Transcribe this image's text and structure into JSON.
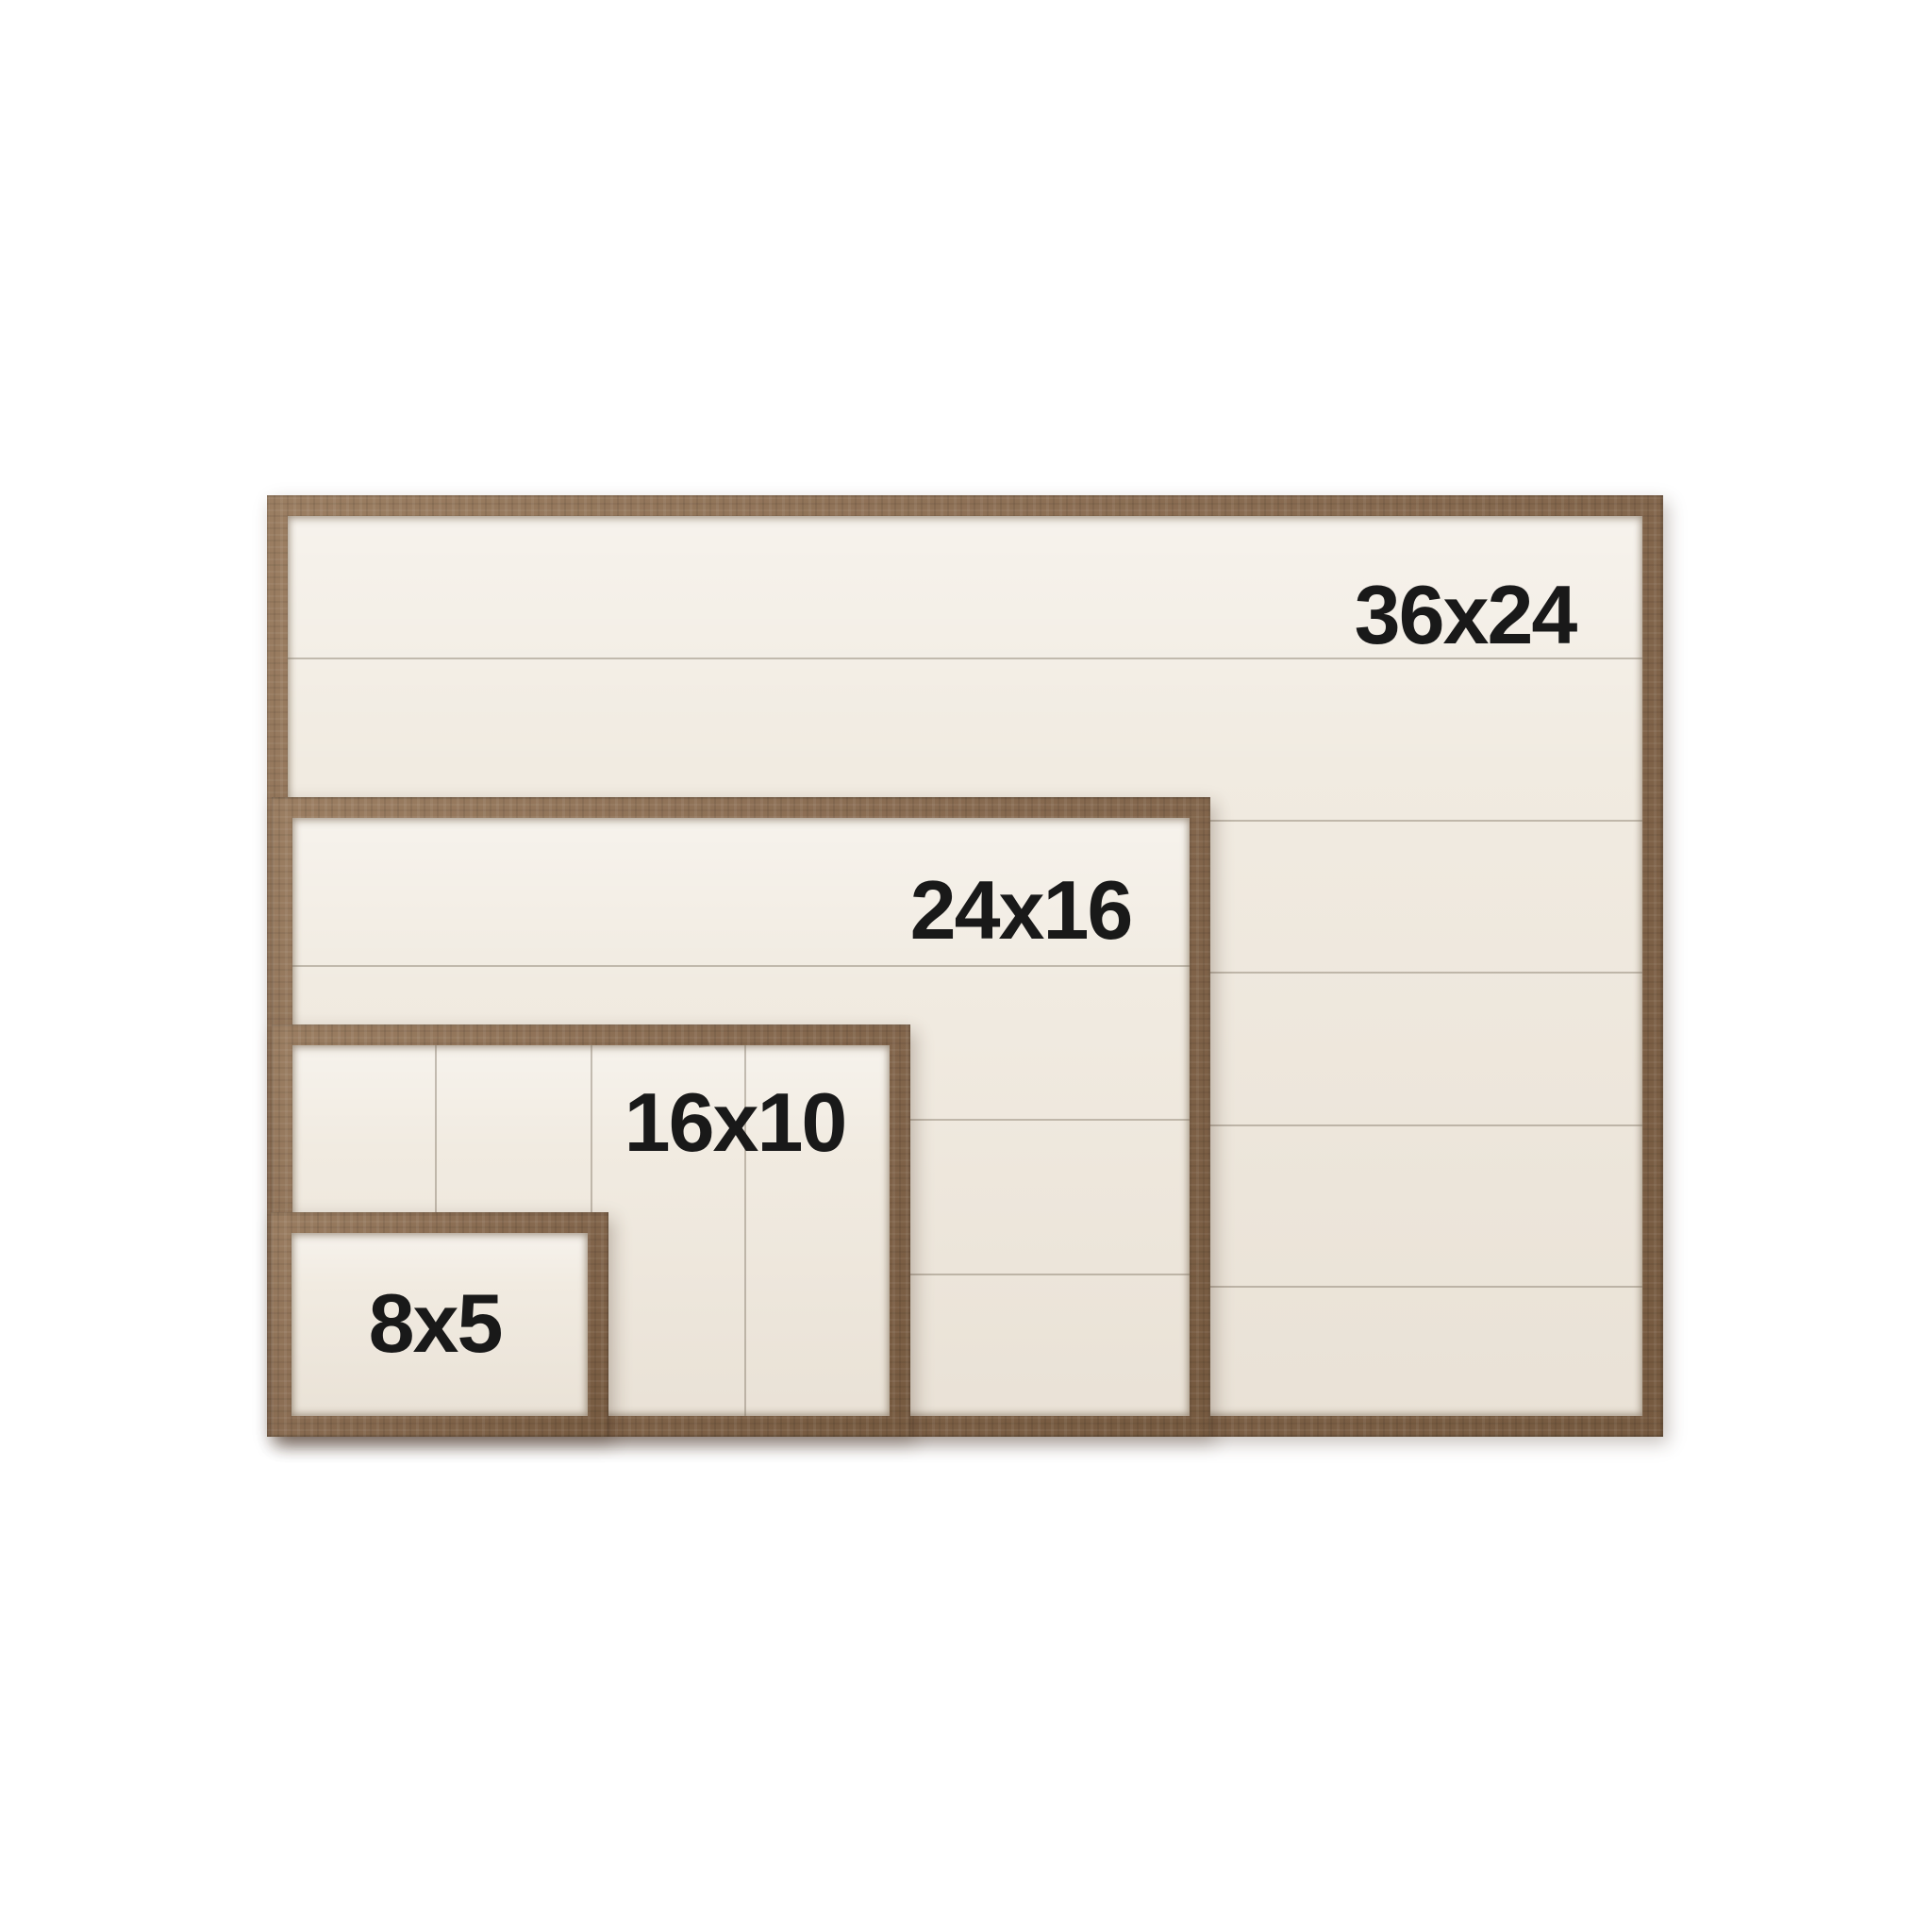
{
  "photo": {
    "background_color": "#ffffff",
    "wood_color": "#8a6c52",
    "panel_color": "#f1ebe1",
    "groove_color": "#7c7060",
    "label_color": "#191919",
    "frames": [
      {
        "label": "36x24",
        "width_in": 36,
        "height_in": 24
      },
      {
        "label": "24x16",
        "width_in": 24,
        "height_in": 16
      },
      {
        "label": "16x10",
        "width_in": 16,
        "height_in": 10
      },
      {
        "label": "8x5",
        "width_in": 8,
        "height_in": 5
      }
    ]
  }
}
